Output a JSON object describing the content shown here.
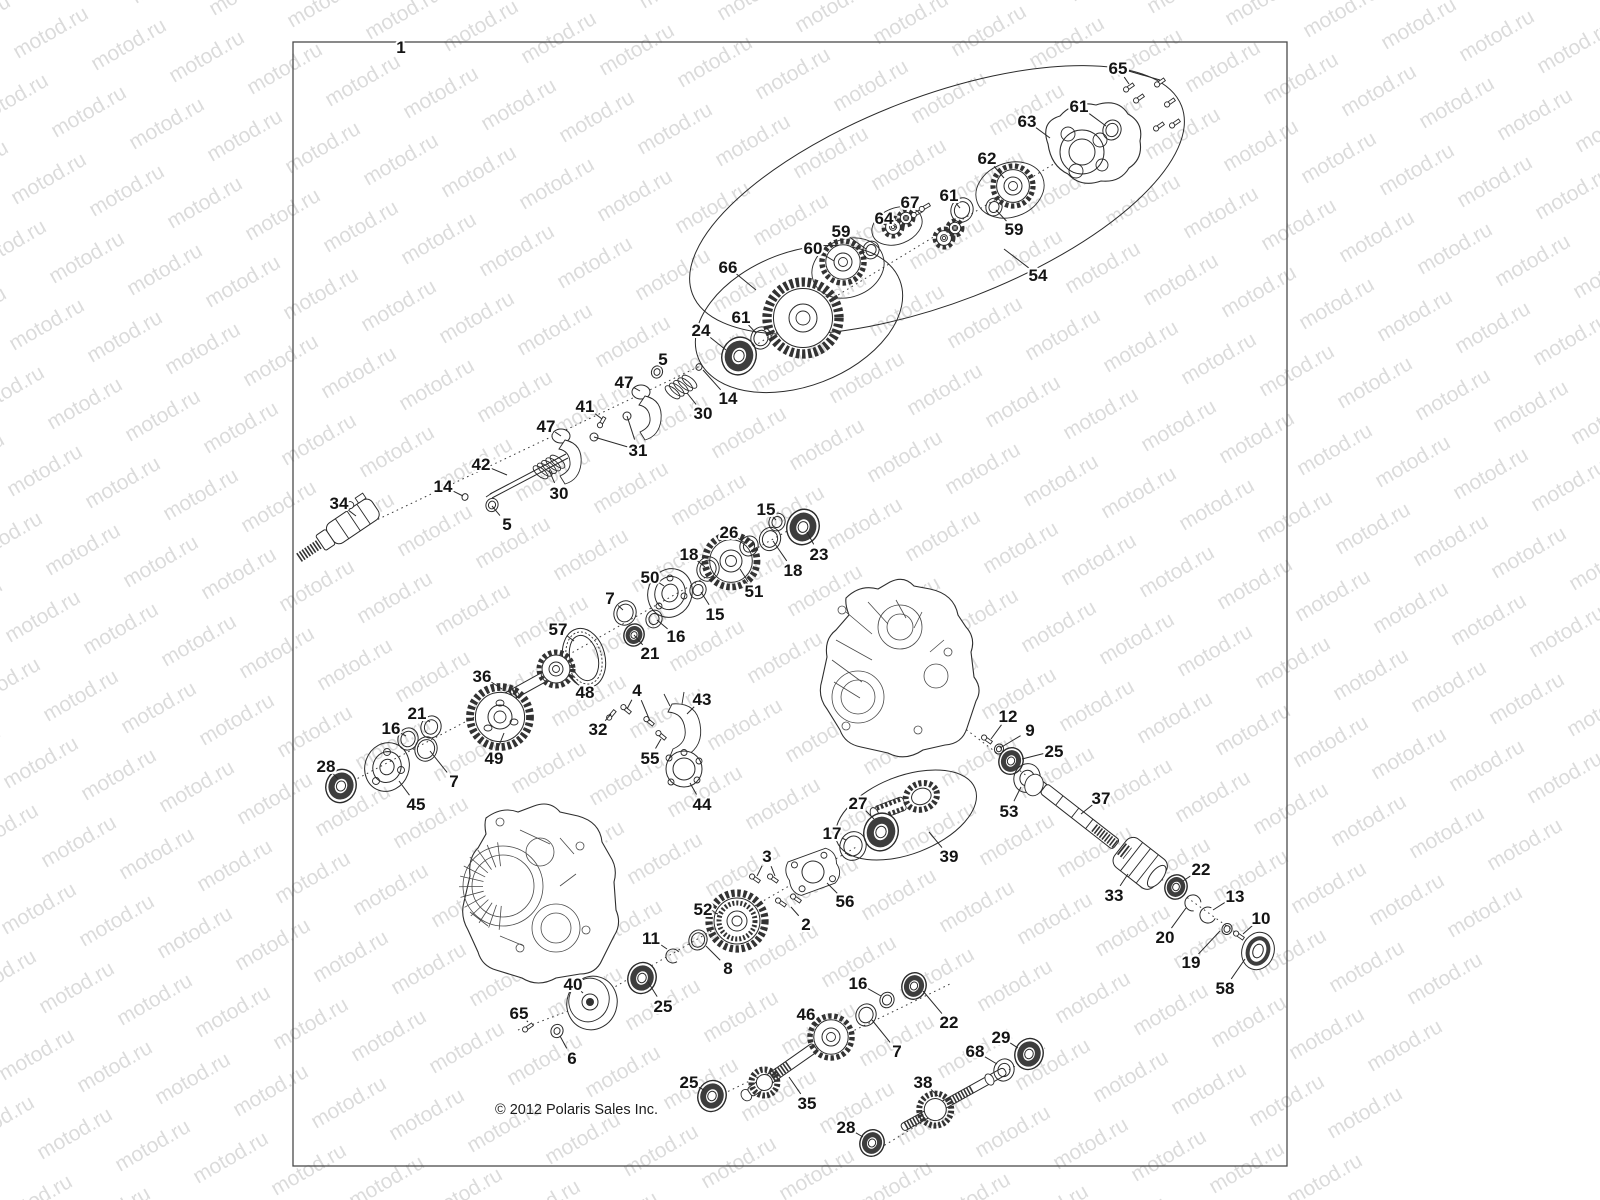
{
  "figure": {
    "ref_label": "1"
  },
  "copyright": "© 2012 Polaris Sales Inc.",
  "watermark": {
    "text": "motod.ru"
  },
  "colors": {
    "line": "#2a2a2a",
    "watermark": "rgba(0,0,0,0.14)",
    "background": "#ffffff"
  },
  "labels": [
    {
      "n": "1",
      "x": 401,
      "y": 47,
      "t": []
    },
    {
      "n": "65",
      "x": 1118,
      "y": 68,
      "t": [
        [
          1129,
          84
        ],
        [
          1160,
          80
        ]
      ]
    },
    {
      "n": "61",
      "x": 1079,
      "y": 106,
      "t": [
        [
          1106,
          126
        ]
      ]
    },
    {
      "n": "63",
      "x": 1027,
      "y": 121,
      "t": [
        [
          1050,
          138
        ]
      ]
    },
    {
      "n": "62",
      "x": 987,
      "y": 158,
      "t": [
        [
          1004,
          178
        ]
      ]
    },
    {
      "n": "67",
      "x": 910,
      "y": 202,
      "t": [
        [
          920,
          214
        ]
      ]
    },
    {
      "n": "64",
      "x": 884,
      "y": 218,
      "t": [
        [
          897,
          228
        ]
      ]
    },
    {
      "n": "61",
      "x": 949,
      "y": 195,
      "t": [
        [
          960,
          208
        ]
      ]
    },
    {
      "n": "59",
      "x": 841,
      "y": 231,
      "t": [
        [
          866,
          249
        ]
      ]
    },
    {
      "n": "60",
      "x": 813,
      "y": 248,
      "t": [
        [
          834,
          261
        ]
      ]
    },
    {
      "n": "59",
      "x": 1014,
      "y": 229,
      "t": [
        [
          996,
          210
        ]
      ]
    },
    {
      "n": "54",
      "x": 1038,
      "y": 275,
      "t": [
        [
          1004,
          249
        ]
      ]
    },
    {
      "n": "66",
      "x": 728,
      "y": 267,
      "t": [
        [
          756,
          290
        ]
      ]
    },
    {
      "n": "61",
      "x": 741,
      "y": 317,
      "t": [
        [
          756,
          333
        ]
      ]
    },
    {
      "n": "24",
      "x": 701,
      "y": 330,
      "t": [
        [
          726,
          350
        ]
      ]
    },
    {
      "n": "14",
      "x": 728,
      "y": 398,
      "t": [
        [
          703,
          370
        ]
      ]
    },
    {
      "n": "30",
      "x": 703,
      "y": 413,
      "t": [
        [
          687,
          393
        ]
      ]
    },
    {
      "n": "5",
      "x": 663,
      "y": 359,
      "t": [
        [
          659,
          369
        ]
      ]
    },
    {
      "n": "47",
      "x": 624,
      "y": 382,
      "t": [
        [
          640,
          391
        ]
      ]
    },
    {
      "n": "41",
      "x": 585,
      "y": 406,
      "t": [
        [
          602,
          419
        ]
      ]
    },
    {
      "n": "31",
      "x": 638,
      "y": 450,
      "t": [
        [
          627,
          416
        ],
        [
          594,
          437
        ]
      ]
    },
    {
      "n": "47",
      "x": 546,
      "y": 426,
      "t": [
        [
          561,
          436
        ]
      ]
    },
    {
      "n": "42",
      "x": 481,
      "y": 464,
      "t": [
        [
          507,
          475
        ]
      ]
    },
    {
      "n": "30",
      "x": 559,
      "y": 493,
      "t": [
        [
          549,
          470
        ]
      ]
    },
    {
      "n": "14",
      "x": 443,
      "y": 486,
      "t": [
        [
          463,
          496
        ]
      ]
    },
    {
      "n": "5",
      "x": 507,
      "y": 524,
      "t": [
        [
          492,
          506
        ]
      ]
    },
    {
      "n": "34",
      "x": 339,
      "y": 503,
      "t": [
        [
          356,
          516
        ]
      ]
    },
    {
      "n": "15",
      "x": 766,
      "y": 509,
      "t": [
        [
          776,
          520
        ]
      ]
    },
    {
      "n": "23",
      "x": 819,
      "y": 554,
      "t": [
        [
          807,
          532
        ]
      ]
    },
    {
      "n": "26",
      "x": 729,
      "y": 532,
      "t": [
        [
          745,
          543
        ]
      ]
    },
    {
      "n": "18",
      "x": 793,
      "y": 570,
      "t": [
        [
          773,
          541
        ]
      ]
    },
    {
      "n": "51",
      "x": 754,
      "y": 591,
      "t": [
        [
          740,
          569
        ]
      ]
    },
    {
      "n": "18",
      "x": 689,
      "y": 554,
      "t": [
        [
          705,
          567
        ]
      ]
    },
    {
      "n": "50",
      "x": 650,
      "y": 577,
      "t": [
        [
          664,
          586
        ]
      ]
    },
    {
      "n": "15",
      "x": 715,
      "y": 614,
      "t": [
        [
          701,
          592
        ]
      ]
    },
    {
      "n": "7",
      "x": 610,
      "y": 598,
      "t": [
        [
          623,
          610
        ]
      ]
    },
    {
      "n": "16",
      "x": 676,
      "y": 636,
      "t": [
        [
          657,
          620
        ]
      ]
    },
    {
      "n": "21",
      "x": 650,
      "y": 653,
      "t": [
        [
          634,
          635
        ]
      ]
    },
    {
      "n": "57",
      "x": 558,
      "y": 629,
      "t": [
        [
          574,
          641
        ]
      ]
    },
    {
      "n": "48",
      "x": 585,
      "y": 692,
      "t": [
        [
          569,
          675
        ]
      ]
    },
    {
      "n": "36",
      "x": 482,
      "y": 676,
      "t": [
        [
          502,
          689
        ]
      ]
    },
    {
      "n": "49",
      "x": 494,
      "y": 758,
      "t": [
        [
          504,
          733
        ]
      ]
    },
    {
      "n": "21",
      "x": 417,
      "y": 713,
      "t": [
        [
          430,
          722
        ]
      ]
    },
    {
      "n": "16",
      "x": 391,
      "y": 728,
      "t": [
        [
          406,
          736
        ]
      ]
    },
    {
      "n": "45",
      "x": 416,
      "y": 804,
      "t": [
        [
          399,
          781
        ]
      ]
    },
    {
      "n": "7",
      "x": 454,
      "y": 781,
      "t": [
        [
          430,
          751
        ]
      ]
    },
    {
      "n": "28",
      "x": 326,
      "y": 766,
      "t": [
        [
          338,
          779
        ]
      ]
    },
    {
      "n": "4",
      "x": 637,
      "y": 690,
      "t": [
        [
          627,
          709
        ],
        [
          650,
          721
        ]
      ]
    },
    {
      "n": "43",
      "x": 702,
      "y": 699,
      "t": [
        [
          687,
          714
        ]
      ]
    },
    {
      "n": "32",
      "x": 598,
      "y": 729,
      "t": [
        [
          611,
          714
        ]
      ]
    },
    {
      "n": "55",
      "x": 650,
      "y": 758,
      "t": [
        [
          661,
          739
        ]
      ]
    },
    {
      "n": "44",
      "x": 702,
      "y": 804,
      "t": [
        [
          690,
          783
        ]
      ]
    },
    {
      "n": "12",
      "x": 1008,
      "y": 716,
      "t": [
        [
          991,
          739
        ]
      ]
    },
    {
      "n": "9",
      "x": 1030,
      "y": 730,
      "t": [
        [
          1000,
          748
        ]
      ]
    },
    {
      "n": "25",
      "x": 1054,
      "y": 751,
      "t": [
        [
          1022,
          759
        ]
      ]
    },
    {
      "n": "53",
      "x": 1009,
      "y": 811,
      "t": [
        [
          1021,
          787
        ]
      ]
    },
    {
      "n": "27",
      "x": 858,
      "y": 803,
      "t": [
        [
          874,
          819
        ]
      ]
    },
    {
      "n": "17",
      "x": 832,
      "y": 833,
      "t": [
        [
          846,
          840
        ]
      ]
    },
    {
      "n": "39",
      "x": 949,
      "y": 856,
      "t": [
        [
          929,
          832
        ]
      ]
    },
    {
      "n": "37",
      "x": 1101,
      "y": 798,
      "t": [
        [
          1081,
          814
        ]
      ]
    },
    {
      "n": "33",
      "x": 1114,
      "y": 895,
      "t": [
        [
          1128,
          874
        ]
      ]
    },
    {
      "n": "22",
      "x": 1201,
      "y": 869,
      "t": [
        [
          1183,
          881
        ]
      ]
    },
    {
      "n": "20",
      "x": 1165,
      "y": 937,
      "t": [
        [
          1186,
          908
        ]
      ]
    },
    {
      "n": "13",
      "x": 1235,
      "y": 896,
      "t": [
        [
          1213,
          910
        ]
      ]
    },
    {
      "n": "19",
      "x": 1191,
      "y": 962,
      "t": [
        [
          1220,
          931
        ]
      ]
    },
    {
      "n": "10",
      "x": 1261,
      "y": 918,
      "t": [
        [
          1243,
          934
        ]
      ]
    },
    {
      "n": "58",
      "x": 1225,
      "y": 988,
      "t": [
        [
          1245,
          959
        ]
      ]
    },
    {
      "n": "56",
      "x": 845,
      "y": 901,
      "t": [
        [
          827,
          883
        ]
      ]
    },
    {
      "n": "3",
      "x": 767,
      "y": 856,
      "t": [
        [
          757,
          876
        ],
        [
          775,
          876
        ]
      ]
    },
    {
      "n": "2",
      "x": 806,
      "y": 924,
      "t": [
        [
          791,
          907
        ]
      ]
    },
    {
      "n": "52",
      "x": 703,
      "y": 909,
      "t": [
        [
          718,
          914
        ]
      ]
    },
    {
      "n": "11",
      "x": 651,
      "y": 938,
      "t": [
        [
          667,
          949
        ]
      ]
    },
    {
      "n": "8",
      "x": 728,
      "y": 968,
      "t": [
        [
          706,
          946
        ]
      ]
    },
    {
      "n": "40",
      "x": 573,
      "y": 984,
      "t": [
        [
          583,
          993
        ]
      ]
    },
    {
      "n": "25",
      "x": 663,
      "y": 1006,
      "t": [
        [
          648,
          982
        ]
      ]
    },
    {
      "n": "65",
      "x": 519,
      "y": 1013,
      "t": [
        [
          528,
          1022
        ]
      ]
    },
    {
      "n": "6",
      "x": 572,
      "y": 1058,
      "t": [
        [
          560,
          1036
        ]
      ]
    },
    {
      "n": "16",
      "x": 858,
      "y": 983,
      "t": [
        [
          881,
          996
        ]
      ]
    },
    {
      "n": "22",
      "x": 949,
      "y": 1022,
      "t": [
        [
          923,
          991
        ]
      ]
    },
    {
      "n": "7",
      "x": 897,
      "y": 1051,
      "t": [
        [
          872,
          1020
        ]
      ]
    },
    {
      "n": "46",
      "x": 806,
      "y": 1014,
      "t": [
        [
          819,
          1026
        ]
      ]
    },
    {
      "n": "68",
      "x": 975,
      "y": 1051,
      "t": [
        [
          997,
          1064
        ]
      ]
    },
    {
      "n": "29",
      "x": 1001,
      "y": 1037,
      "t": [
        [
          1018,
          1048
        ]
      ]
    },
    {
      "n": "38",
      "x": 923,
      "y": 1082,
      "t": [
        [
          938,
          1096
        ]
      ]
    },
    {
      "n": "35",
      "x": 807,
      "y": 1103,
      "t": [
        [
          789,
          1077
        ]
      ]
    },
    {
      "n": "25",
      "x": 689,
      "y": 1082,
      "t": [
        [
          704,
          1090
        ]
      ]
    },
    {
      "n": "28",
      "x": 846,
      "y": 1127,
      "t": [
        [
          863,
          1137
        ]
      ]
    }
  ]
}
